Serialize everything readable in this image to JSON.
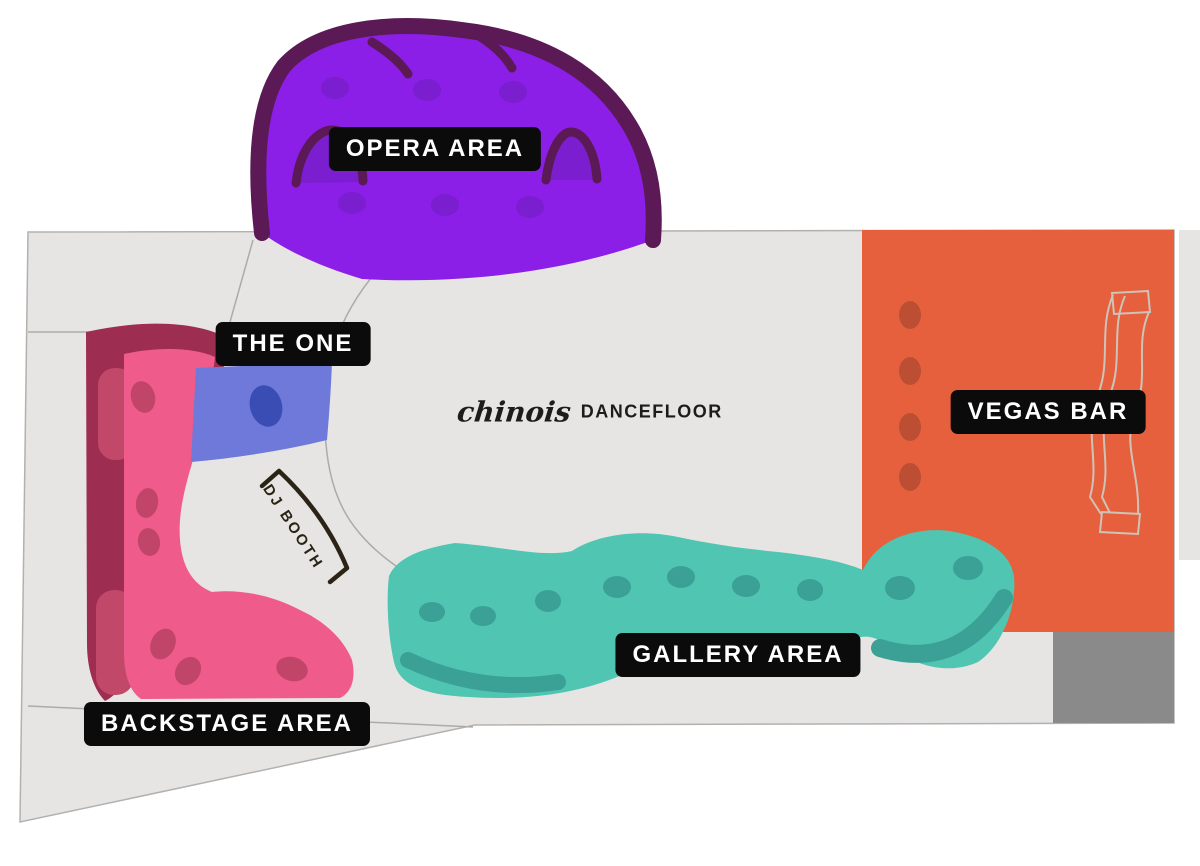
{
  "page": {
    "background": "#FFFFFF"
  },
  "map": {
    "floor": {
      "color": "#E6E5E3",
      "outline": "#B3B1AF",
      "wall_line": "#ADABA8",
      "lower_right_block_color": "#8A8A8A"
    },
    "label_chip": {
      "bg": "#0B0B0B",
      "text": "#FFFFFF"
    },
    "areas": {
      "opera": {
        "label": "OPERA AREA",
        "color": "#8B1FE8",
        "accent_dark": "#5B1A55",
        "accent_mid": "#7B1ECF"
      },
      "the_one": {
        "label": "THE ONE",
        "color": "#6E79DA",
        "dot_color": "#3A4DB4"
      },
      "vegas_bar": {
        "label": "VEGAS BAR",
        "color": "#E6603D",
        "dot_color": "#BC4F33",
        "counter_outline": "#CDC3B6"
      },
      "gallery": {
        "label": "GALLERY AREA",
        "color": "#4FC5B2",
        "accent": "#3BA095"
      },
      "backstage": {
        "label": "BACKSTAGE AREA",
        "color": "#EF5B8B",
        "band": "#9E2D52",
        "patch": "#C24869",
        "dot_color": "#C04568"
      },
      "dj_booth": {
        "label": "DJ BOOTH",
        "ink": "#2B2416"
      },
      "dancefloor": {
        "brand": "chinois",
        "label": "DANCEFLOOR",
        "ink": "#1C1C1C"
      }
    }
  }
}
